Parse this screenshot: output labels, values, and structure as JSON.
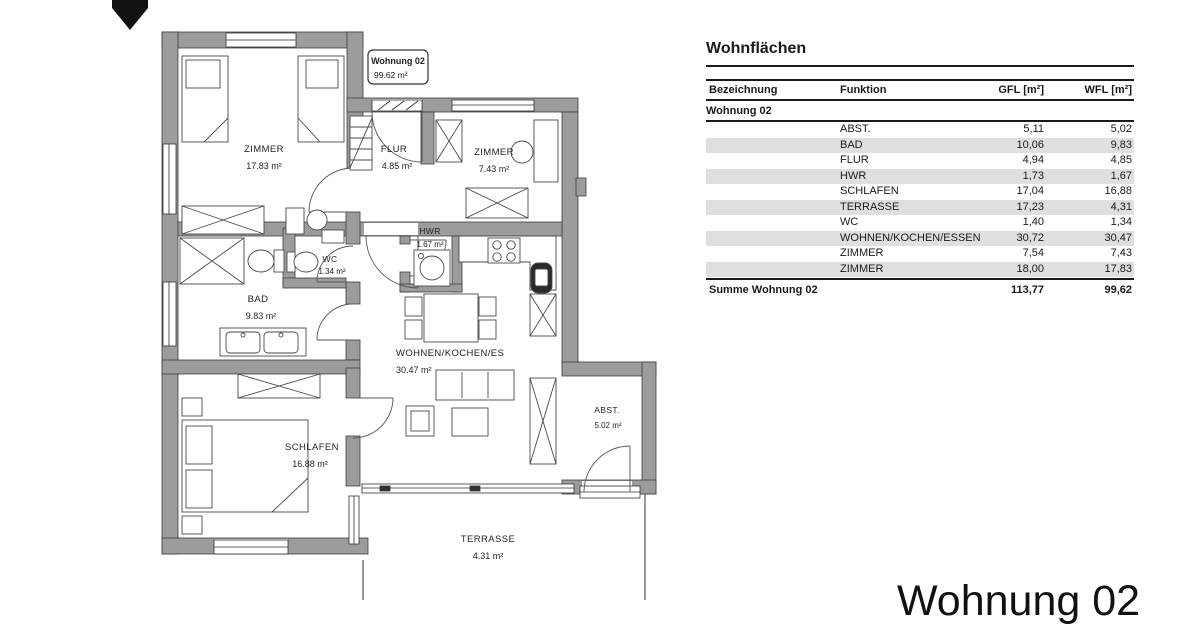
{
  "plan": {
    "unit_label": {
      "title": "Wohnung 02",
      "area": "99.62 m²"
    },
    "rooms": [
      {
        "name": "ZIMMER",
        "area": "17.83 m²"
      },
      {
        "name": "FLUR",
        "area": "4.85 m²"
      },
      {
        "name": "ZIMMER",
        "area": "7.43 m²"
      },
      {
        "name": "HWR",
        "area": "1.67 m²"
      },
      {
        "name": "WC",
        "area": "1.34 m²"
      },
      {
        "name": "BAD",
        "area": "9.83 m²"
      },
      {
        "name": "WOHNEN/KOCHEN/ES",
        "area": "30.47 m²"
      },
      {
        "name": "SCHLAFEN",
        "area": "16.88 m²"
      },
      {
        "name": "ABST.",
        "area": "5.02 m²"
      },
      {
        "name": "TERRASSE",
        "area": "4.31 m²"
      }
    ],
    "colors": {
      "wall": "#9c9c9c",
      "outline": "#3e3e3e",
      "furniture": "#4a4a4a"
    }
  },
  "table": {
    "title": "Wohnflächen",
    "columns": [
      "Bezeichnung",
      "Funktion",
      "GFL [m²]",
      "WFL [m²]"
    ],
    "section": "Wohnung 02",
    "rows": [
      {
        "funktion": "ABST.",
        "gfl": "5,11",
        "wfl": "5,02"
      },
      {
        "funktion": "BAD",
        "gfl": "10,06",
        "wfl": "9,83"
      },
      {
        "funktion": "FLUR",
        "gfl": "4,94",
        "wfl": "4,85"
      },
      {
        "funktion": "HWR",
        "gfl": "1,73",
        "wfl": "1,67"
      },
      {
        "funktion": "SCHLAFEN",
        "gfl": "17,04",
        "wfl": "16,88"
      },
      {
        "funktion": "TERRASSE",
        "gfl": "17,23",
        "wfl": "4,31"
      },
      {
        "funktion": "WC",
        "gfl": "1,40",
        "wfl": "1,34"
      },
      {
        "funktion": "WOHNEN/KOCHEN/ESSEN",
        "gfl": "30,72",
        "wfl": "30,47"
      },
      {
        "funktion": "ZIMMER",
        "gfl": "7,54",
        "wfl": "7,43"
      },
      {
        "funktion": "ZIMMER",
        "gfl": "18,00",
        "wfl": "17,83"
      }
    ],
    "sum": {
      "label": "Summe Wohnung 02",
      "gfl": "113,77",
      "wfl": "99,62"
    },
    "row_shade": "#dfdfdf"
  },
  "footer": {
    "title": "Wohnung 02"
  }
}
